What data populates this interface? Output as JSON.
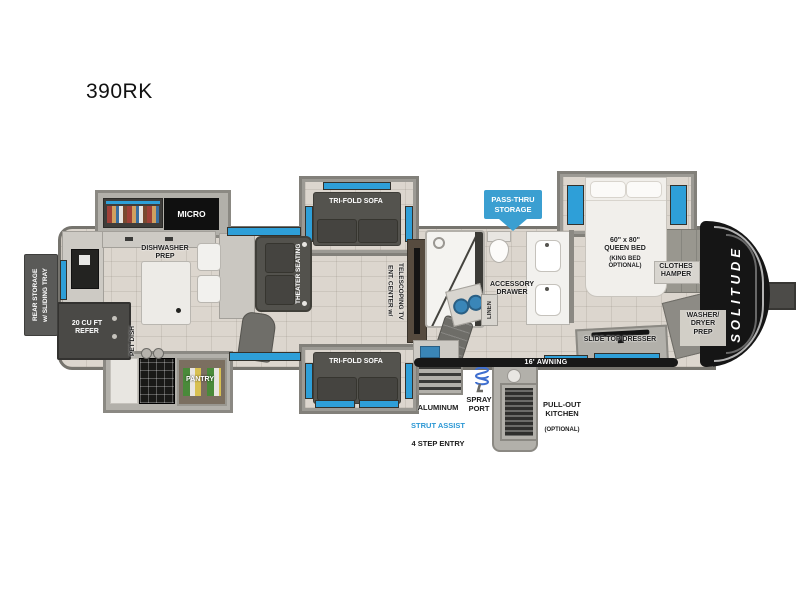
{
  "title": "390RK",
  "colors": {
    "accent_blue": "#2e9fd8",
    "badge_blue": "#3b9fd1",
    "strut_blue": "#2b97d4",
    "cap_black": "#151515",
    "floor_tan": "#dcd6ce"
  },
  "exterior": {
    "rear_storage": "REAR STORAGE\nw/ SLIDING TRAY",
    "pass_thru": "PASS-THRU\nSTORAGE",
    "awning": "16' AWNING",
    "solitude": "SOLITUDE",
    "entry_line1": "ALUMINUM",
    "entry_line2": "STRUT ASSIST",
    "entry_line3": "4 STEP ENTRY",
    "spray_port": "SPRAY\nPORT",
    "pullout_kitchen": "PULL-OUT\nKITCHEN",
    "pullout_optional": "(OPTIONAL)"
  },
  "kitchen": {
    "micro": "MICRO",
    "dishwasher_prep": "DISHWASHER\nPREP",
    "refer": "20 CU FT\nREFER",
    "pet_dish": "PET DISH",
    "pantry": "PANTRY"
  },
  "living": {
    "theater_seating": "THEATER SEATING",
    "sofa_top": "TRI-FOLD SOFA",
    "sofa_bottom": "TRI-FOLD SOFA",
    "ent_center": "ENT. CENTER w/\nTELESCOPING TV"
  },
  "bath": {
    "accessory_drawer": "ACCESSORY\nDRAWER",
    "linen": "LINEN"
  },
  "bedroom": {
    "queen_bed": "60\" x 80\"\nQUEEN BED",
    "queen_bed_option": "(KING BED\nOPTIONAL)",
    "clothes_hamper": "CLOTHES\nHAMPER",
    "washer_dryer": "WASHER/\nDRYER\nPREP",
    "slide_top_dresser": "SLIDE TOP DRESSER"
  }
}
